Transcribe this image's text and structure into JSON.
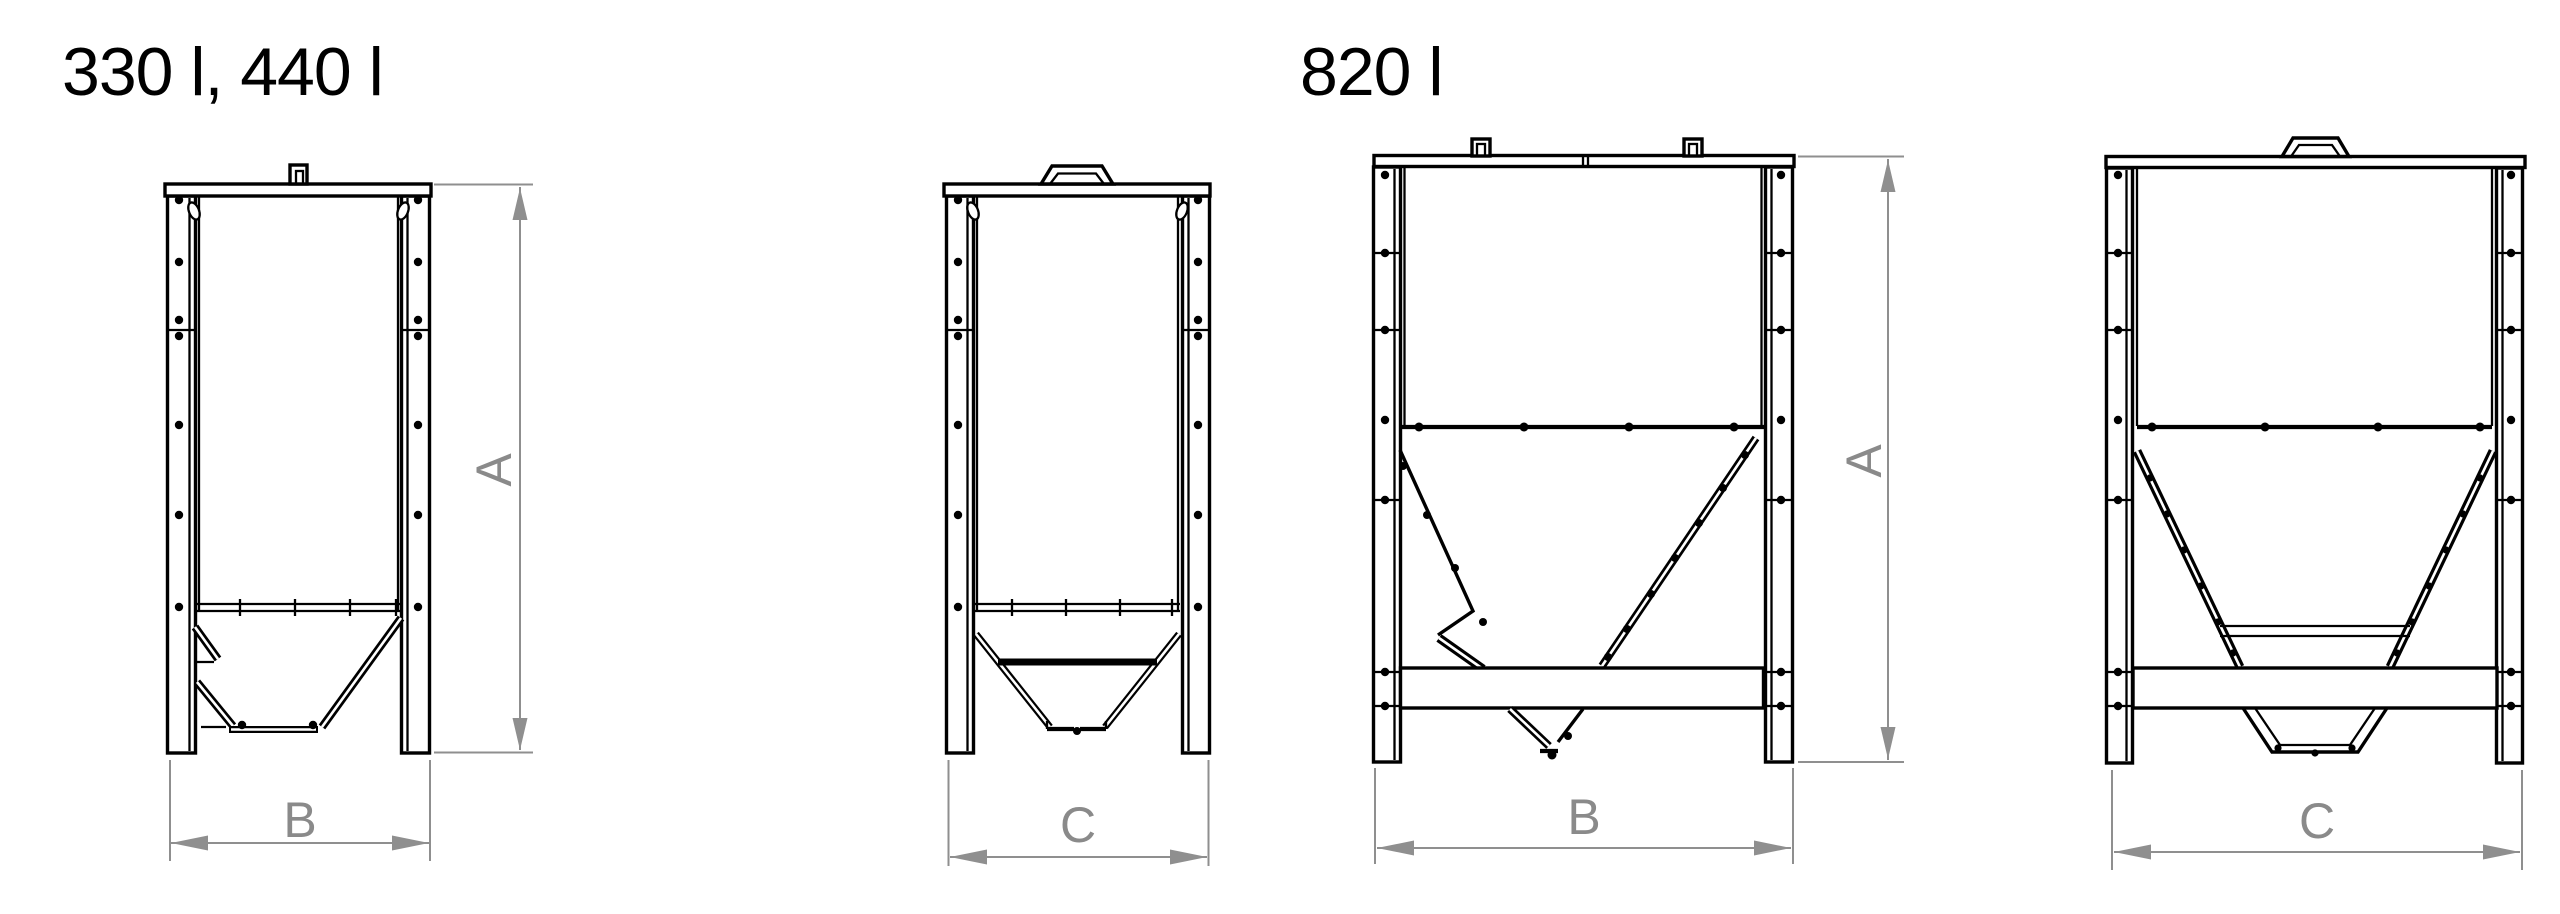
{
  "page": {
    "background": "#ffffff",
    "drawing_color": "#000000",
    "dimension_line_color": "#8f8f8f",
    "dimension_label_color": "#8a8a8a"
  },
  "titles": {
    "small_silos": "330 l, 440 l",
    "large_silo": "820 l"
  },
  "dimension_labels": {
    "height": "A",
    "width": "B",
    "depth": "C"
  }
}
